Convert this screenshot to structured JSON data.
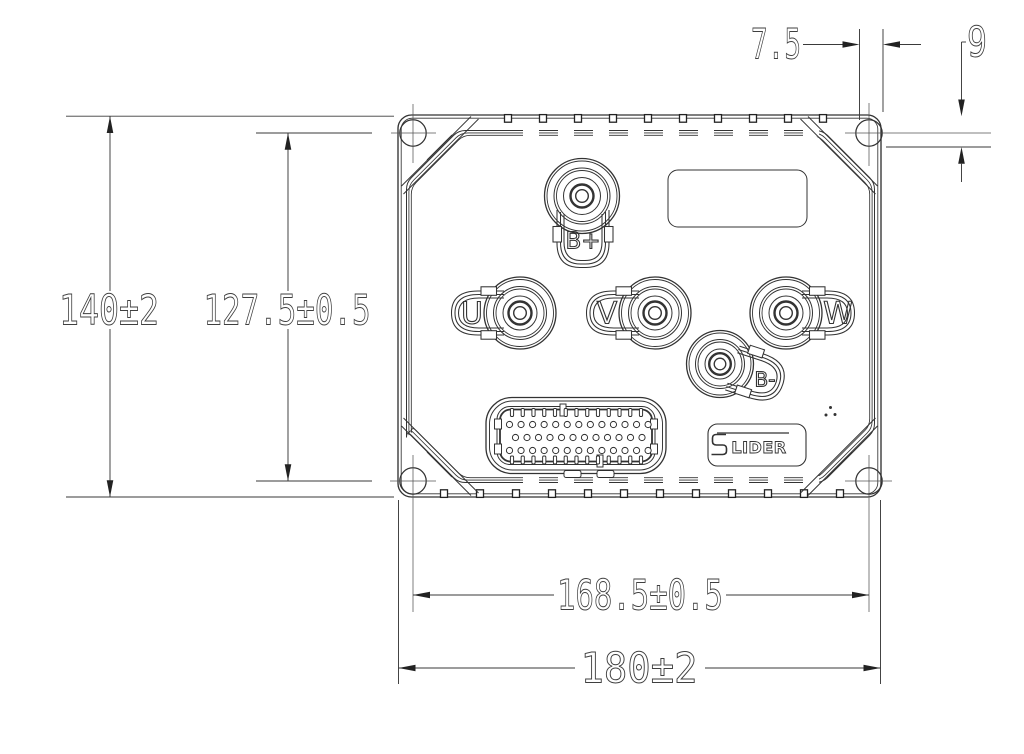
{
  "drawing": {
    "dims": {
      "overall_height": "140±2",
      "mount_hole_spacing_v": "127.5±0.5",
      "edge_offset_h": "7.5",
      "edge_offset_v": "9",
      "mount_hole_spacing_h": "168.5±0.5",
      "overall_width": "180±2"
    },
    "terminals": {
      "b_plus": "B+",
      "phase_u": "U",
      "phase_v": "V",
      "phase_w": "W",
      "b_minus": "B-"
    },
    "logo": {
      "initial_bar": "",
      "rest": "LIDER"
    }
  }
}
